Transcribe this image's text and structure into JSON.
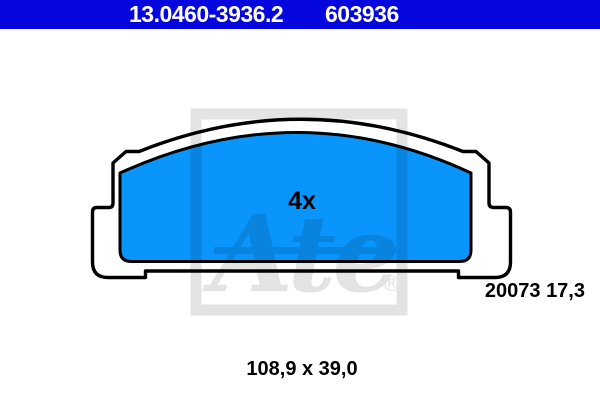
{
  "header": {
    "part_number": "13.0460-3936.2",
    "reference_number": "603936",
    "bar_color": "#0505dd",
    "text_color": "#ffffff"
  },
  "diagram": {
    "quantity_label": "4x",
    "wva_label": "20073 17,3",
    "dimensions_label": "108,9 x 39,0",
    "pad_fill_color": "#0995fb",
    "plate_fill_color": "#ffffff",
    "outline_color": "#000000",
    "watermark": {
      "text": "Ate",
      "registered_mark": "®"
    }
  }
}
